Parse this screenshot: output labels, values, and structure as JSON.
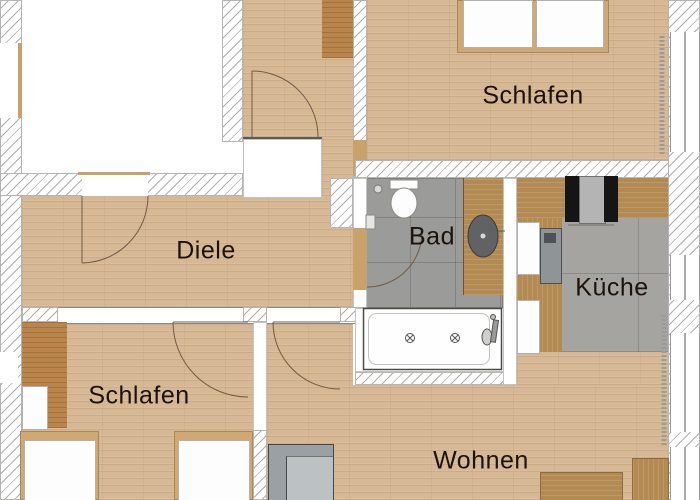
{
  "rooms": {
    "schlafen_top": "Schlafen",
    "diele": "Diele",
    "bad": "Bad",
    "kueche": "Küche",
    "schlafen_bottom": "Schlafen",
    "wohnen": "Wohnen"
  },
  "palette": {
    "wood_floor": "#d7b895",
    "wood_furniture_dark": "#b9854a",
    "wood_counter": "#b28a52",
    "bed_frame_tan": "#cfa873",
    "tile_bathroom": "#9b9b99",
    "tile_kitchen": "#a5a4a0",
    "wall_white": "#ffffff",
    "hatch_line": "#adadab",
    "sofa_gray": "#9aa0a3",
    "appliance_black": "#151515",
    "appliance_gray": "#b4b4b4",
    "sink_basin_gray": "#606264",
    "label_text": "#1c120b"
  },
  "fixtures": [
    "toilet-icon",
    "washbasin-icon",
    "bathtub-icon",
    "stove-icon",
    "kitchen-sink-icon",
    "radiator-icon",
    "door-swing-arc"
  ]
}
